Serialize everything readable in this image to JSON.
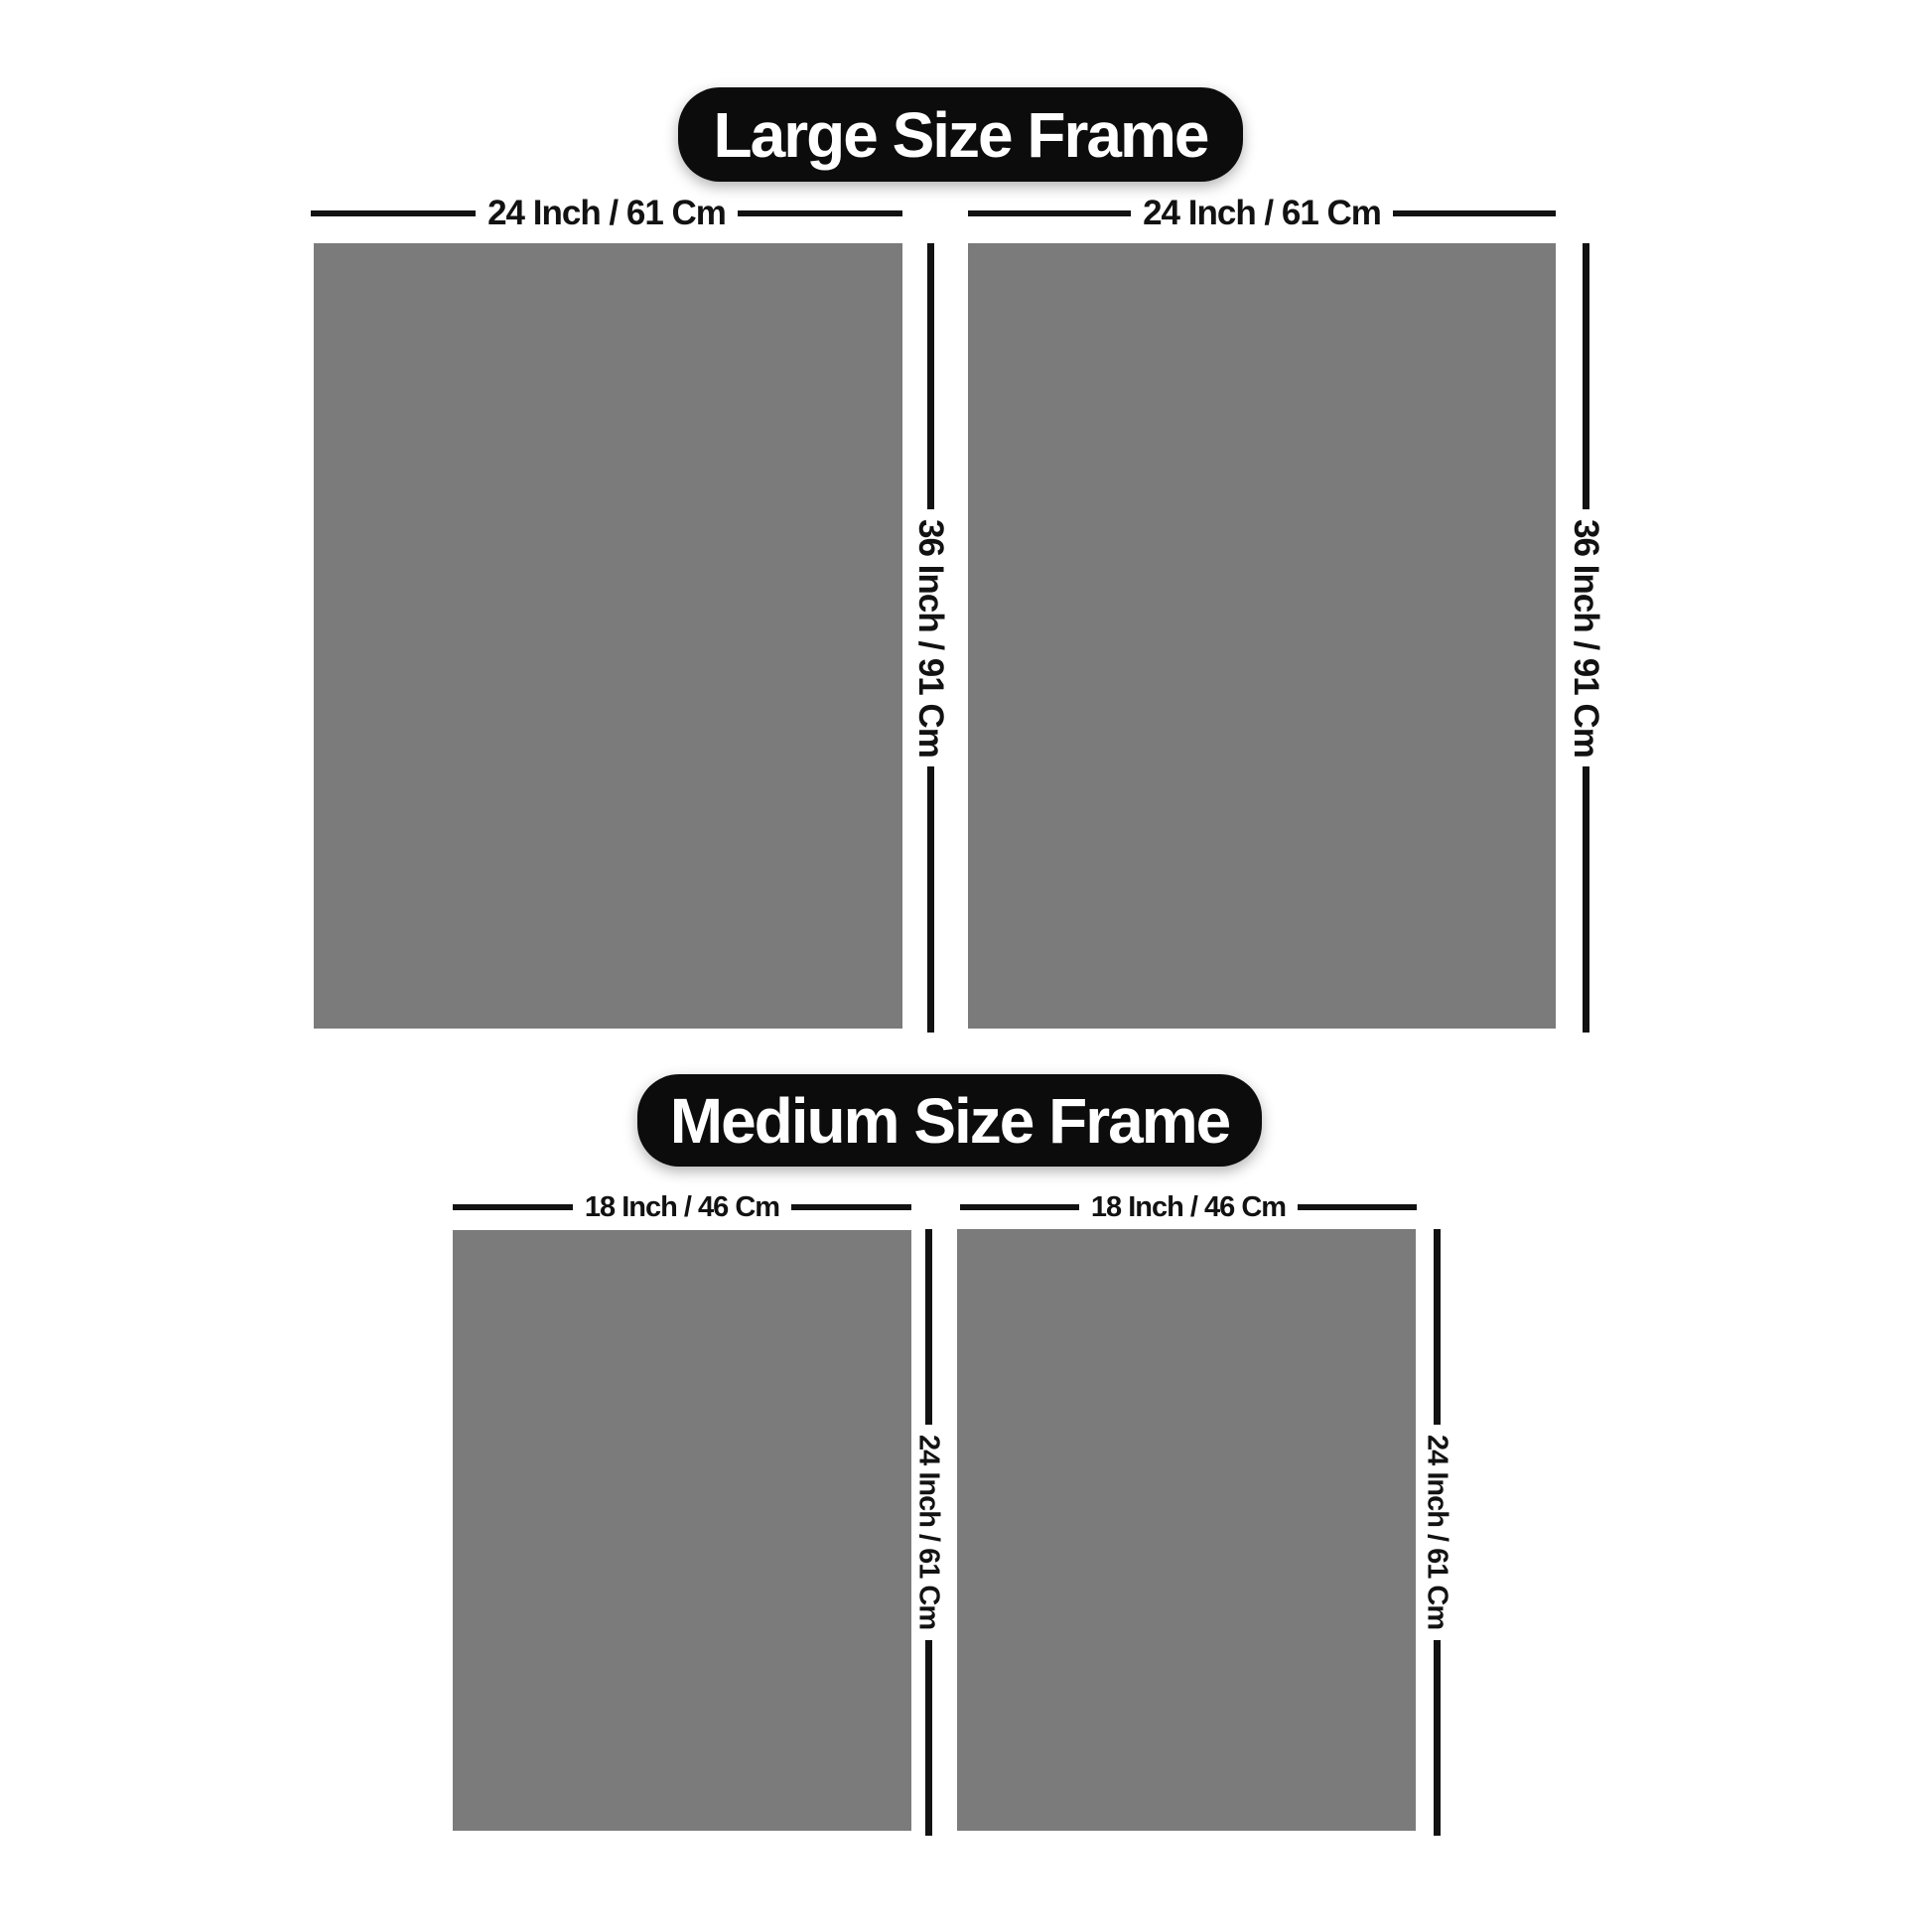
{
  "sections": [
    {
      "id": "large",
      "title": "Large Size Frame",
      "frames": [
        {
          "width_label": "24 Inch / 61 Cm",
          "height_label": "36 Inch / 91 Cm"
        },
        {
          "width_label": "24 Inch / 61 Cm",
          "height_label": "36 Inch / 91 Cm"
        }
      ]
    },
    {
      "id": "medium",
      "title": "Medium Size Frame",
      "frames": [
        {
          "width_label": "18 Inch / 46 Cm",
          "height_label": "24 Inch / 61 Cm"
        },
        {
          "width_label": "18 Inch / 46 Cm",
          "height_label": "24 Inch / 61 Cm"
        }
      ]
    }
  ],
  "colors": {
    "background": "#ffffff",
    "frame_fill": "#7b7b7b",
    "dimension_line": "#121212",
    "label_text": "#121212",
    "pill_background": "#0c0c0c",
    "pill_text": "#ffffff"
  }
}
